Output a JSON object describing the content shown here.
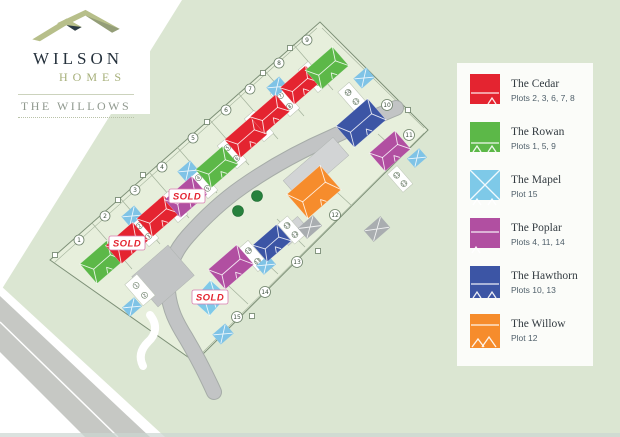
{
  "brand": {
    "name": "WILSON",
    "suffix": "HOMES",
    "development": "THE WILLOWS"
  },
  "legend": {
    "items": [
      {
        "id": "cedar",
        "name": "The Cedar",
        "plots": "Plots 2, 3, 6, 7, 8",
        "color": "#e42430"
      },
      {
        "id": "rowan",
        "name": "The Rowan",
        "plots": "Plots 1, 5, 9",
        "color": "#5cb848"
      },
      {
        "id": "mapel",
        "name": "The Mapel",
        "plots": "Plot 15",
        "color": "#7ec9e8"
      },
      {
        "id": "poplar",
        "name": "The Poplar",
        "plots": "Plots 4, 11, 14",
        "color": "#b14fa1"
      },
      {
        "id": "hawthorn",
        "name": "The Hawthorn",
        "plots": "Plots 10, 13",
        "color": "#3c55a5"
      },
      {
        "id": "willow",
        "name": "The Willow",
        "plots": "Plot 12",
        "color": "#f68c2c"
      }
    ]
  },
  "site": {
    "sold_label": "SOLD",
    "plot_numbers": {
      "p1": "1",
      "p2": "2",
      "p3": "3",
      "p4": "4",
      "p5": "5",
      "p6": "6",
      "p7": "7",
      "p8": "8",
      "p9": "9",
      "p10": "10",
      "p11": "11",
      "p12": "12",
      "p13": "13",
      "p14": "14",
      "p15": "15"
    },
    "houses": [
      {
        "plot": "1",
        "type": "rowan",
        "sold": false
      },
      {
        "plot": "2",
        "type": "cedar",
        "sold": true
      },
      {
        "plot": "3",
        "type": "cedar",
        "sold": false
      },
      {
        "plot": "4",
        "type": "poplar",
        "sold": true
      },
      {
        "plot": "5",
        "type": "rowan",
        "sold": false
      },
      {
        "plot": "6",
        "type": "cedar",
        "sold": false
      },
      {
        "plot": "7",
        "type": "cedar",
        "sold": false
      },
      {
        "plot": "8",
        "type": "cedar",
        "sold": false
      },
      {
        "plot": "9",
        "type": "rowan",
        "sold": false
      },
      {
        "plot": "10",
        "type": "hawthorn",
        "sold": false
      },
      {
        "plot": "11",
        "type": "poplar",
        "sold": false
      },
      {
        "plot": "12",
        "type": "willow",
        "sold": false
      },
      {
        "plot": "13",
        "type": "hawthorn",
        "sold": false
      },
      {
        "plot": "14",
        "type": "poplar",
        "sold": false
      },
      {
        "plot": "15",
        "type": "mapel",
        "sold": true
      }
    ],
    "bays": {
      "d1": [
        "1",
        "2"
      ],
      "d23": [
        "2",
        "3"
      ],
      "d34": [
        "3",
        "4"
      ],
      "d45": [
        "4",
        "5"
      ],
      "d56": [
        "5",
        "6"
      ],
      "d67": [
        "6",
        "7"
      ],
      "d78": [
        "7",
        "8"
      ],
      "d89": [
        "8",
        "9"
      ],
      "d1314": [
        "14",
        "13"
      ],
      "d1213": [
        "13",
        "12"
      ],
      "d10": [
        "10",
        "11"
      ],
      "d11": [
        "11",
        "11"
      ]
    }
  },
  "colors": {
    "canvas": "#dbe6d2",
    "site_fill": "#e7efdc",
    "road": "#c2c4c5",
    "parking": "#d2d4d5",
    "driveway": "#ffffff",
    "garage_blue": "#7fc3e6",
    "tree_green": "#27813d",
    "sold_red": "#e42430",
    "boundary": "#7d9077",
    "legend_bg": "#fbfcf9"
  }
}
